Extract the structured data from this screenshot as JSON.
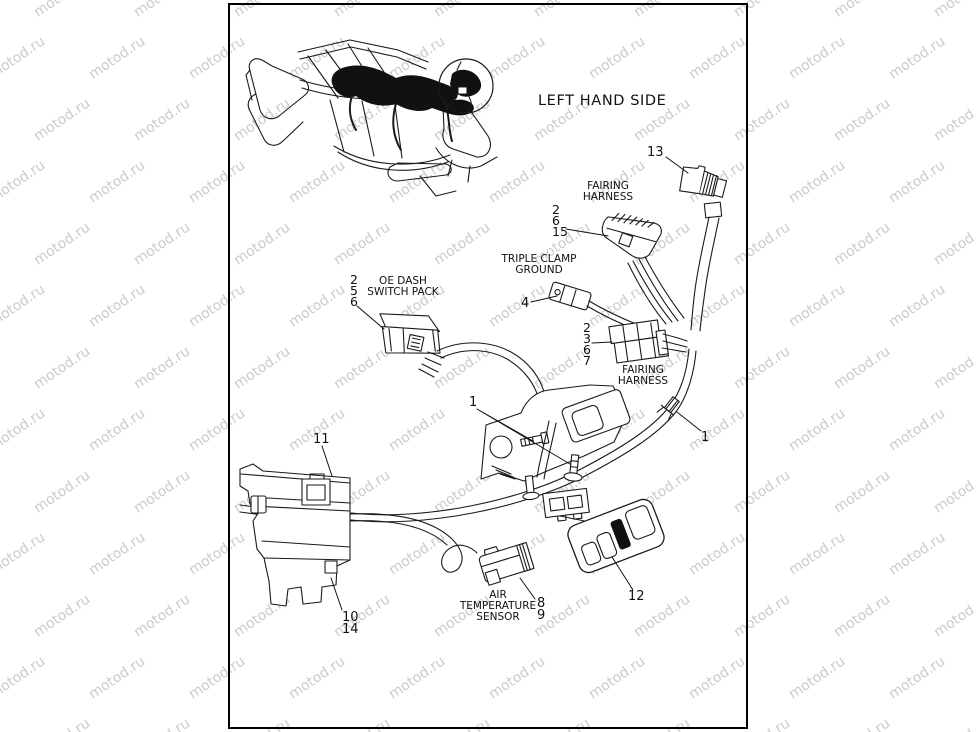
{
  "watermark": {
    "text": "motod.ru",
    "color": "#cbcbcb"
  },
  "diagram": {
    "title": "LEFT HAND SIDE",
    "ink_color": "#111111",
    "labels": {
      "fairing_harness_top": [
        "FAIRING",
        "HARNESS"
      ],
      "triple_clamp_ground": [
        "TRIPLE CLAMP",
        "GROUND"
      ],
      "oe_dash_switch_pack": [
        "OE DASH",
        "SWITCH PACK"
      ],
      "fairing_harness_mid": [
        "FAIRING",
        "HARNESS"
      ],
      "air_temperature_sensor": [
        "AIR",
        "TEMPERATURE",
        "SENSOR"
      ]
    },
    "callouts": {
      "item13": "13",
      "group_2_6_15": [
        "2",
        "6",
        "15"
      ],
      "item4": "4",
      "group_2_5_6": [
        "2",
        "5",
        "6"
      ],
      "group_2_3_6_7": [
        "2",
        "3",
        "6",
        "7"
      ],
      "item1_center": "1",
      "item1_right": "1",
      "item11": "11",
      "group_10_14": [
        "10",
        "14"
      ],
      "group_8_9": [
        "8",
        "9"
      ],
      "item12": "12"
    }
  }
}
